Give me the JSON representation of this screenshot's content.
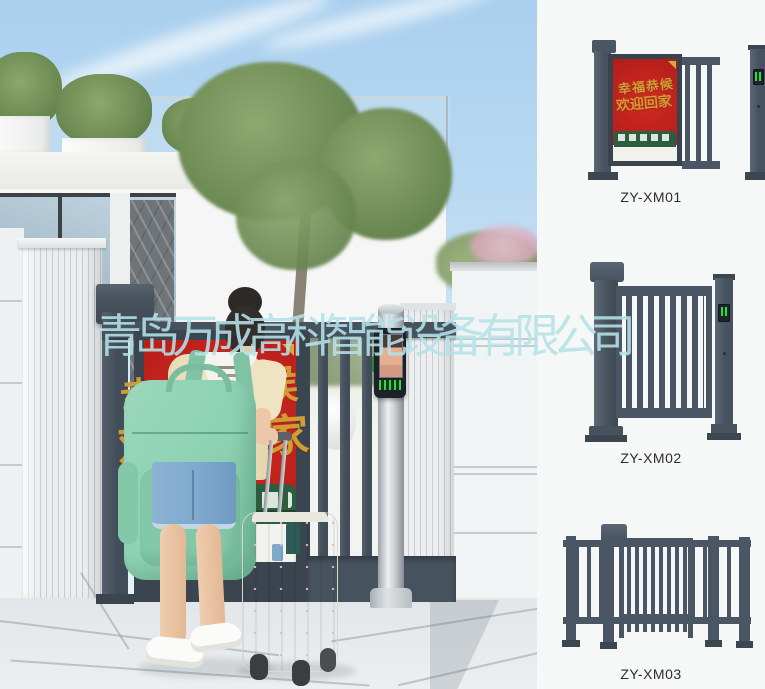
{
  "watermark": {
    "text": "青岛万成高科智能设备有限公司",
    "color": "#b5e3e9"
  },
  "poster": {
    "line1": "幸福恭候",
    "line2": "欢迎回家"
  },
  "products": [
    {
      "label": "ZY-XM01"
    },
    {
      "label": "ZY-XM02"
    },
    {
      "label": "ZY-XM03"
    }
  ],
  "colors": {
    "gate_frame": "#46525e",
    "poster_red": "#c1251d",
    "calligraphy_gold": "#cf9c35",
    "reader_green": "#38d44f",
    "train_green": "#2d5c3e",
    "backpack_mint": "#8dd1b2",
    "denim_blue": "#7fa9cf",
    "catalog_background": "#f6f7f7"
  }
}
